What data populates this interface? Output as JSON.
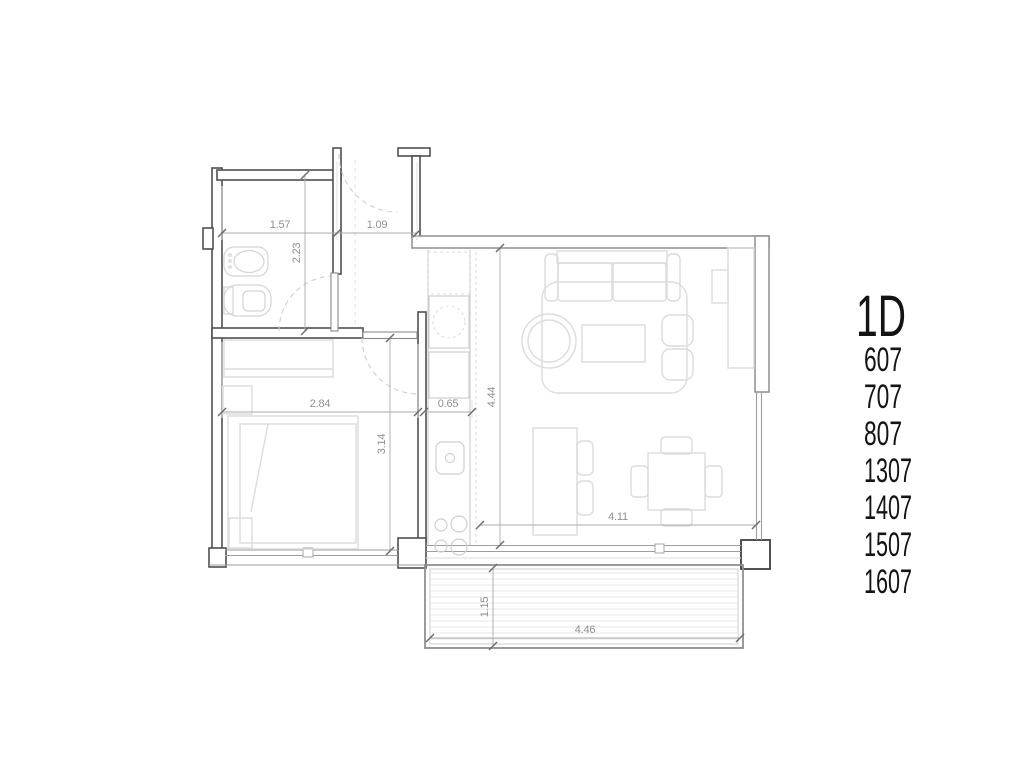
{
  "plan": {
    "unit_label": "1D",
    "unit_numbers": [
      "607",
      "707",
      "807",
      "1307",
      "1407",
      "1507",
      "1607"
    ],
    "dimensions": {
      "bath_width": "1.57",
      "entry_width": "1.09",
      "bath_depth": "2.23",
      "bedroom_width": "2.84",
      "kitchen_width": "0.65",
      "living_depth": "4.44",
      "bedroom_depth": "3.14",
      "living_width": "4.11",
      "balcony_depth": "1.15",
      "balcony_width": "4.46"
    },
    "colors": {
      "wall": "#4f4f4f",
      "wall_light": "#8f8f8f",
      "furniture": "#dcdcdc",
      "dimension_text": "#8f8f8f",
      "label_text": "#141414",
      "background": "#ffffff"
    }
  }
}
